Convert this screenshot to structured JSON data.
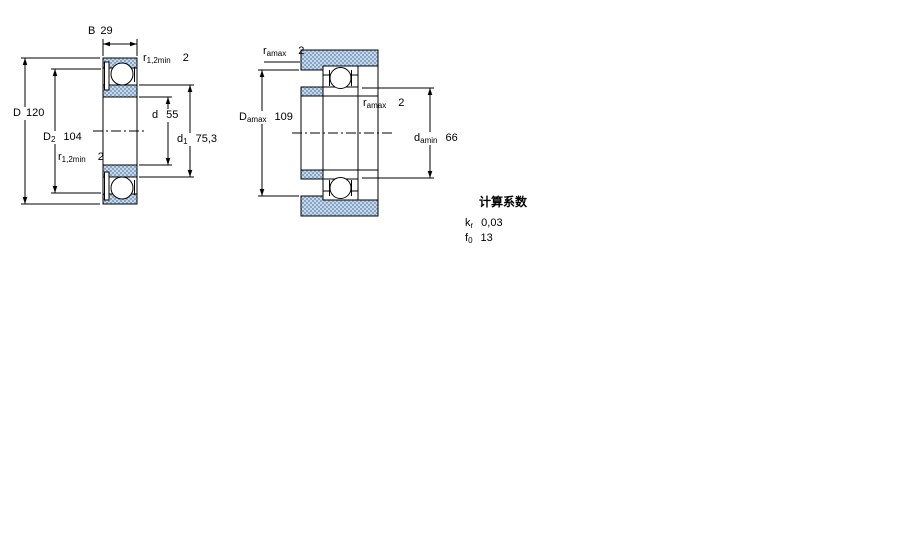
{
  "drawing_type": "bearing-dimension-drawing",
  "colors": {
    "background": "#ffffff",
    "line": "#000000",
    "hatch_base": "#c7d7e8",
    "hatch_dot": "#84a6c8"
  },
  "left_diagram": {
    "name": "bearing-cross-section",
    "dims": {
      "B": {
        "sym": "B",
        "sub": "",
        "value": "29"
      },
      "D": {
        "sym": "D",
        "sub": "",
        "value": "120"
      },
      "D2": {
        "sym": "D",
        "sub": "2",
        "value": "104"
      },
      "r_top": {
        "sym": "r",
        "sub": "1,2min",
        "value": "2"
      },
      "r_bottom": {
        "sym": "r",
        "sub": "1,2min",
        "value": "2"
      },
      "d": {
        "sym": "d",
        "sub": "",
        "value": "55"
      },
      "d1": {
        "sym": "d",
        "sub": "1",
        "value": "75,3"
      }
    }
  },
  "right_diagram": {
    "name": "abutment-dimensions-section",
    "dims": {
      "ra_top": {
        "sym": "r",
        "sub": "amax",
        "value": "2"
      },
      "Da": {
        "sym": "D",
        "sub": "amax",
        "value": "109"
      },
      "ra_mid": {
        "sym": "r",
        "sub": "amax",
        "value": "2"
      },
      "da": {
        "sym": "d",
        "sub": "amin",
        "value": "66"
      }
    }
  },
  "calculation_factors": {
    "heading": "计算系数",
    "rows": [
      {
        "sym": "k",
        "sub": "r",
        "value": "0,03"
      },
      {
        "sym": "f",
        "sub": "0",
        "value": "13"
      }
    ]
  }
}
